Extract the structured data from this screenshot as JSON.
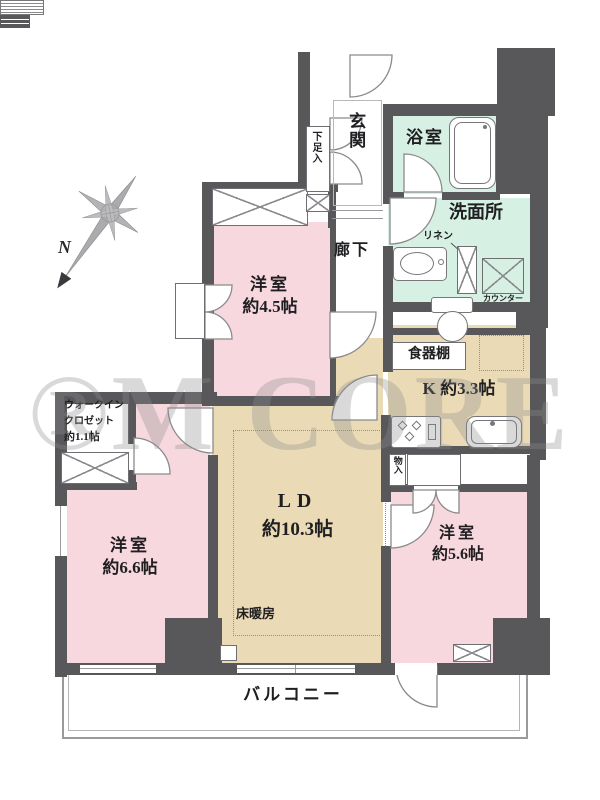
{
  "plan": {
    "watermark": "®M CORE",
    "compass": {
      "north_label": "N"
    },
    "rooms": {
      "genkan": {
        "label": "玄関"
      },
      "shoe_cabinet": {
        "label": "下足入"
      },
      "bathroom": {
        "label": "浴室"
      },
      "washroom": {
        "label": "洗面所"
      },
      "linen": {
        "label": "リネン"
      },
      "counter": {
        "label": "カウンター"
      },
      "corridor": {
        "label": "廊下"
      },
      "western_room_4_5": {
        "label": "洋室",
        "size": "約4.5帖"
      },
      "dish_cabinet": {
        "label": "食器棚"
      },
      "kitchen": {
        "label": "K 約3.3帖"
      },
      "walk_in_closet": {
        "label_line1": "ウォークイン",
        "label_line2": "クロゼット",
        "label_line3": "約1.1帖"
      },
      "living_dining": {
        "label": "LD",
        "size": "約10.3帖"
      },
      "floor_heating": {
        "label": "床暖房"
      },
      "western_room_6_6": {
        "label": "洋室",
        "size": "約6.6帖"
      },
      "western_room_5_6": {
        "label": "洋室",
        "size": "約5.6帖"
      },
      "storage": {
        "label": "物入"
      },
      "balcony": {
        "label": "バルコニー"
      }
    },
    "colors": {
      "wall": "#58585b",
      "room_pink": "#f8d8df",
      "water_mint": "#d6f0e3",
      "living_beige": "#ebdab6",
      "outline_gray": "#8a8a8e"
    }
  }
}
